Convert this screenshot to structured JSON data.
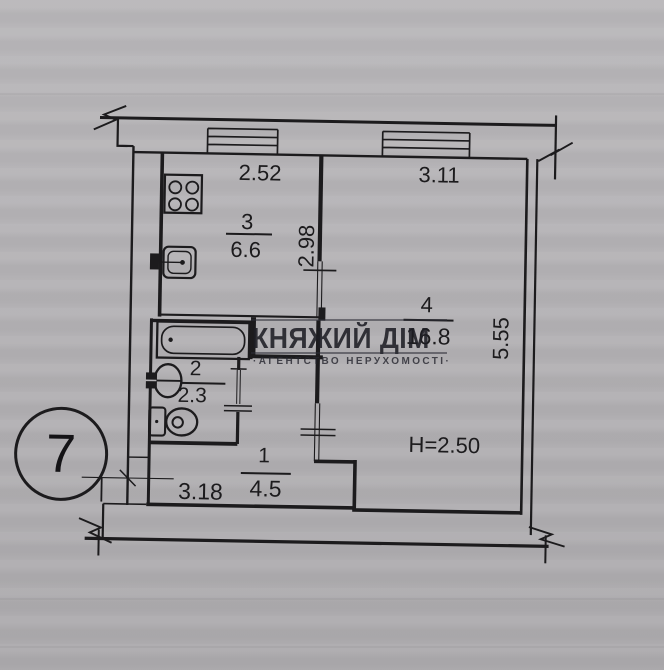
{
  "plan": {
    "badge_number": "7",
    "height_label": "H=2.50",
    "rooms": [
      {
        "number": "1",
        "area": "4.5"
      },
      {
        "number": "2",
        "area": "2.3"
      },
      {
        "number": "3",
        "area": "6.6"
      },
      {
        "number": "4",
        "area": "16.8"
      }
    ],
    "dimensions": {
      "kitchen_width": "2.52",
      "kitchen_depth": "2.98",
      "room_width": "3.11",
      "room_depth": "5.55",
      "hall_width": "3.18"
    },
    "fixture_icons": [
      "stove-icon",
      "kitchen-sink-icon",
      "bathtub-icon",
      "washbasin-icon",
      "toilet-icon",
      "window-icon",
      "wall-break-icon"
    ]
  },
  "watermark": {
    "title": "КНЯЖИЙ ДІМ",
    "subtitle": "·АГЕНТСТВО НЕРУХОМОСТІ·"
  },
  "colors": {
    "paper": "#b6b4b7",
    "ink": "#1c1b1d"
  }
}
